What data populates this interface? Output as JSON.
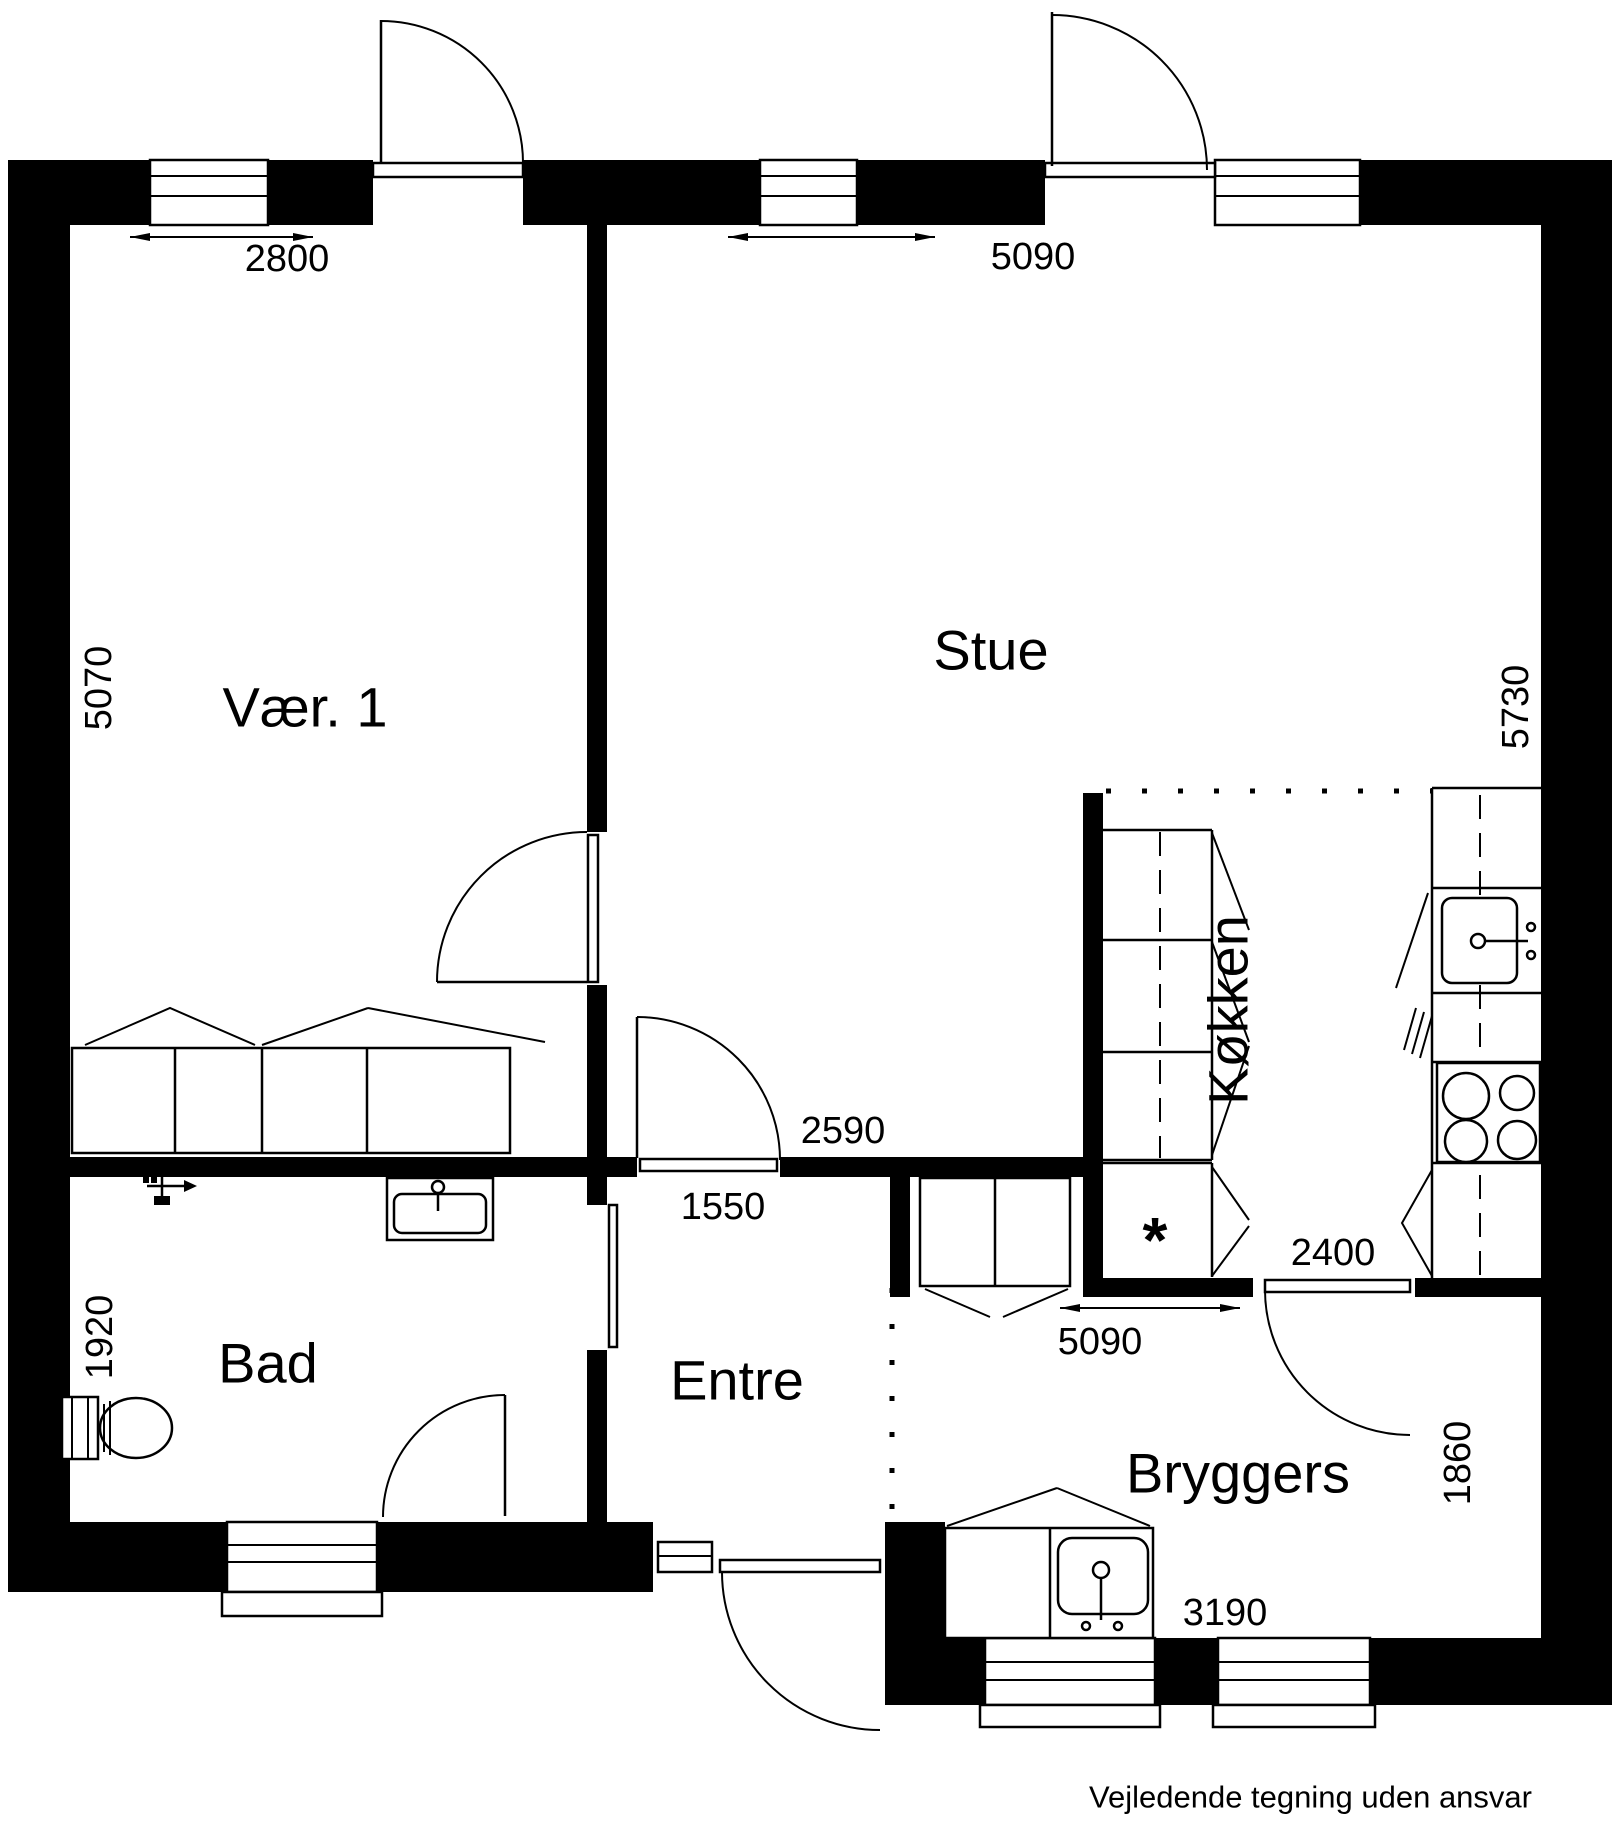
{
  "rooms": {
    "vaer1": "Vær. 1",
    "stue": "Stue",
    "koekken": "Køkken",
    "bad": "Bad",
    "entre": "Entre",
    "bryggers": "Bryggers"
  },
  "dimensions": {
    "vaer1_width": "2800",
    "stue_width": "5090",
    "vaer1_depth": "5070",
    "koekken_depth": "5730",
    "passage_width": "2590",
    "entre_door_width": "1550",
    "bad_depth": "1920",
    "koekken_width": "2400",
    "bryggers_top_width": "5090",
    "bryggers_depth": "1860",
    "bryggers_width": "3190"
  },
  "symbols": {
    "freezer_mark": "*"
  },
  "footer": {
    "disclaimer": "Vejledende tegning uden ansvar"
  },
  "colors": {
    "wall": "#000000",
    "line": "#000000",
    "background": "#ffffff"
  }
}
